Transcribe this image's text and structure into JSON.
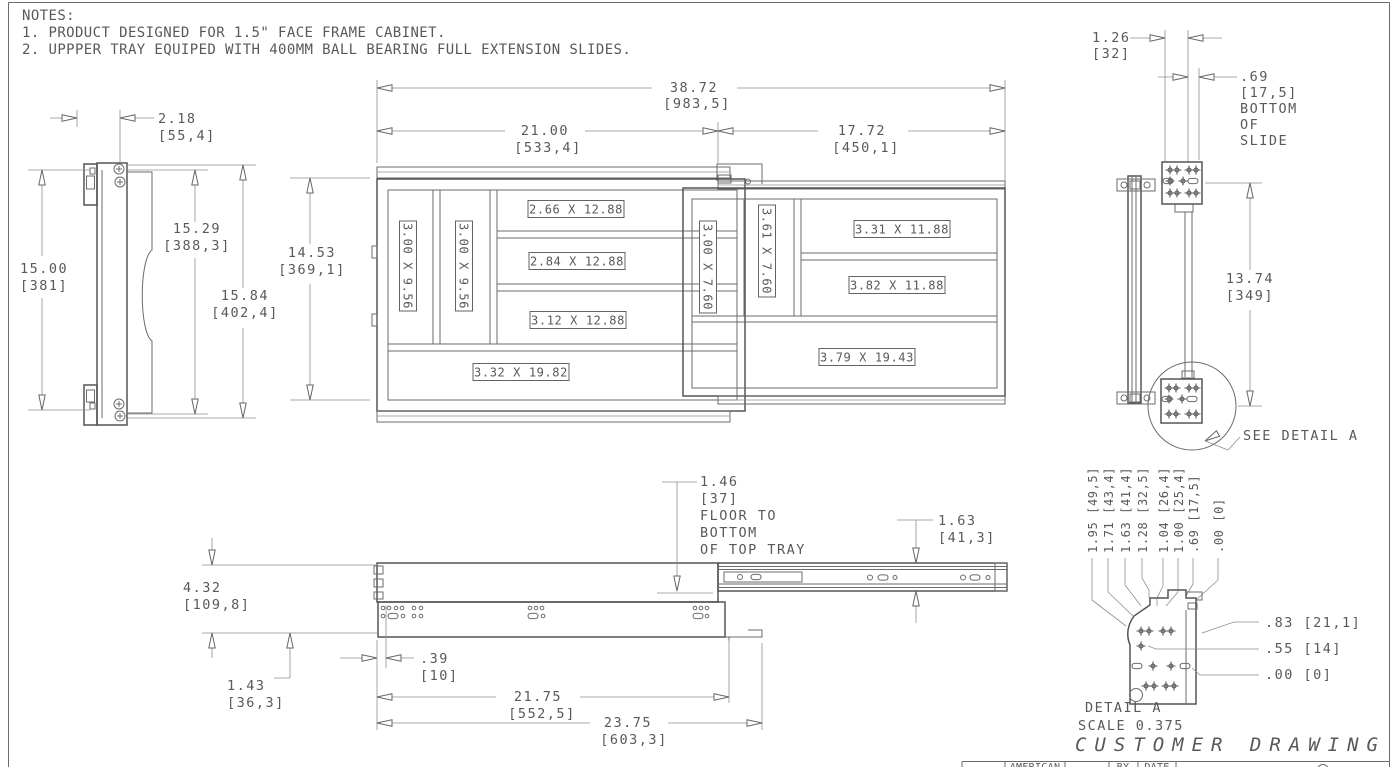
{
  "notes": {
    "heading": "NOTES:",
    "items": [
      "1. PRODUCT DESIGNED FOR 1.5\" FACE FRAME CABINET.",
      "2. UPPPER TRAY EQUIPED WITH 400MM BALL BEARING FULL EXTENSION SLIDES."
    ]
  },
  "left_side_view": {
    "dims": {
      "offset_in": "2.18",
      "offset_mm": "[55,4]",
      "height1_in": "15.00",
      "height1_mm": "[381]",
      "height2_in": "15.29",
      "height2_mm": "[388,3]",
      "height3_in": "15.84",
      "height3_mm": "[402,4]"
    }
  },
  "plan_view": {
    "dims": {
      "overall_width_in": "38.72",
      "overall_width_mm": "[983,5]",
      "lower_tray_width_in": "21.00",
      "lower_tray_width_mm": "[533,4]",
      "upper_tray_width_in": "17.72",
      "upper_tray_width_mm": "[450,1]",
      "depth_in": "14.53",
      "depth_mm": "[369,1]"
    },
    "lower_tray_compartments": [
      "3.00 X 9.56",
      "3.00 X 9.56",
      "2.66 X 12.88",
      "2.84 X 12.88",
      "3.12 X 12.88",
      "3.32 X 19.82"
    ],
    "upper_tray_compartments": [
      "3.00 X 7.60",
      "3.61 X 7.60",
      "3.31 X 11.88",
      "3.82 X 11.88",
      "3.79 X 19.43"
    ]
  },
  "right_side_view": {
    "dims": {
      "width_in": "1.26",
      "width_mm": "[32]",
      "slide_in": ".69",
      "slide_mm": "[17,5]",
      "height_in": "13.74",
      "height_mm": "[349]"
    },
    "slide_note": [
      "BOTTOM",
      "OF",
      "SLIDE"
    ],
    "callout": "SEE DETAIL A"
  },
  "front_view": {
    "dims": {
      "floor_in": "1.46",
      "floor_mm": "[37]",
      "slide_h_in": "1.63",
      "slide_h_mm": "[41,3]",
      "tray_h_in": "4.32",
      "tray_h_mm": "[109,8]",
      "bottom_in": "1.43",
      "bottom_mm": "[36,3]",
      "setback_in": ".39",
      "setback_mm": "[10]",
      "slide_len_in": "21.75",
      "slide_len_mm": "[552,5]",
      "overall_len_in": "23.75",
      "overall_len_mm": "[603,3]"
    },
    "floor_note": [
      "FLOOR TO",
      "BOTTOM",
      "OF TOP TRAY"
    ]
  },
  "detail_a": {
    "vertical_dims": [
      "1.95 [49,5]",
      "1.71 [43,4]",
      "1.63 [41,4]",
      "1.28 [32,5]",
      "1.04 [26,4]",
      "1.00 [25,4]",
      ".69 [17,5]",
      ".00 [0]"
    ],
    "horizontal_dims": [
      ".83 [21,1]",
      ".55 [14]",
      ".00 [0]"
    ],
    "title": "DETAIL  A",
    "scale": "SCALE  0.375"
  },
  "title_block": {
    "company": "AMERICAN",
    "by_label": "BY",
    "date_label": "DATE"
  },
  "footer": {
    "customer_drawing": "CUSTOMER DRAWING"
  }
}
